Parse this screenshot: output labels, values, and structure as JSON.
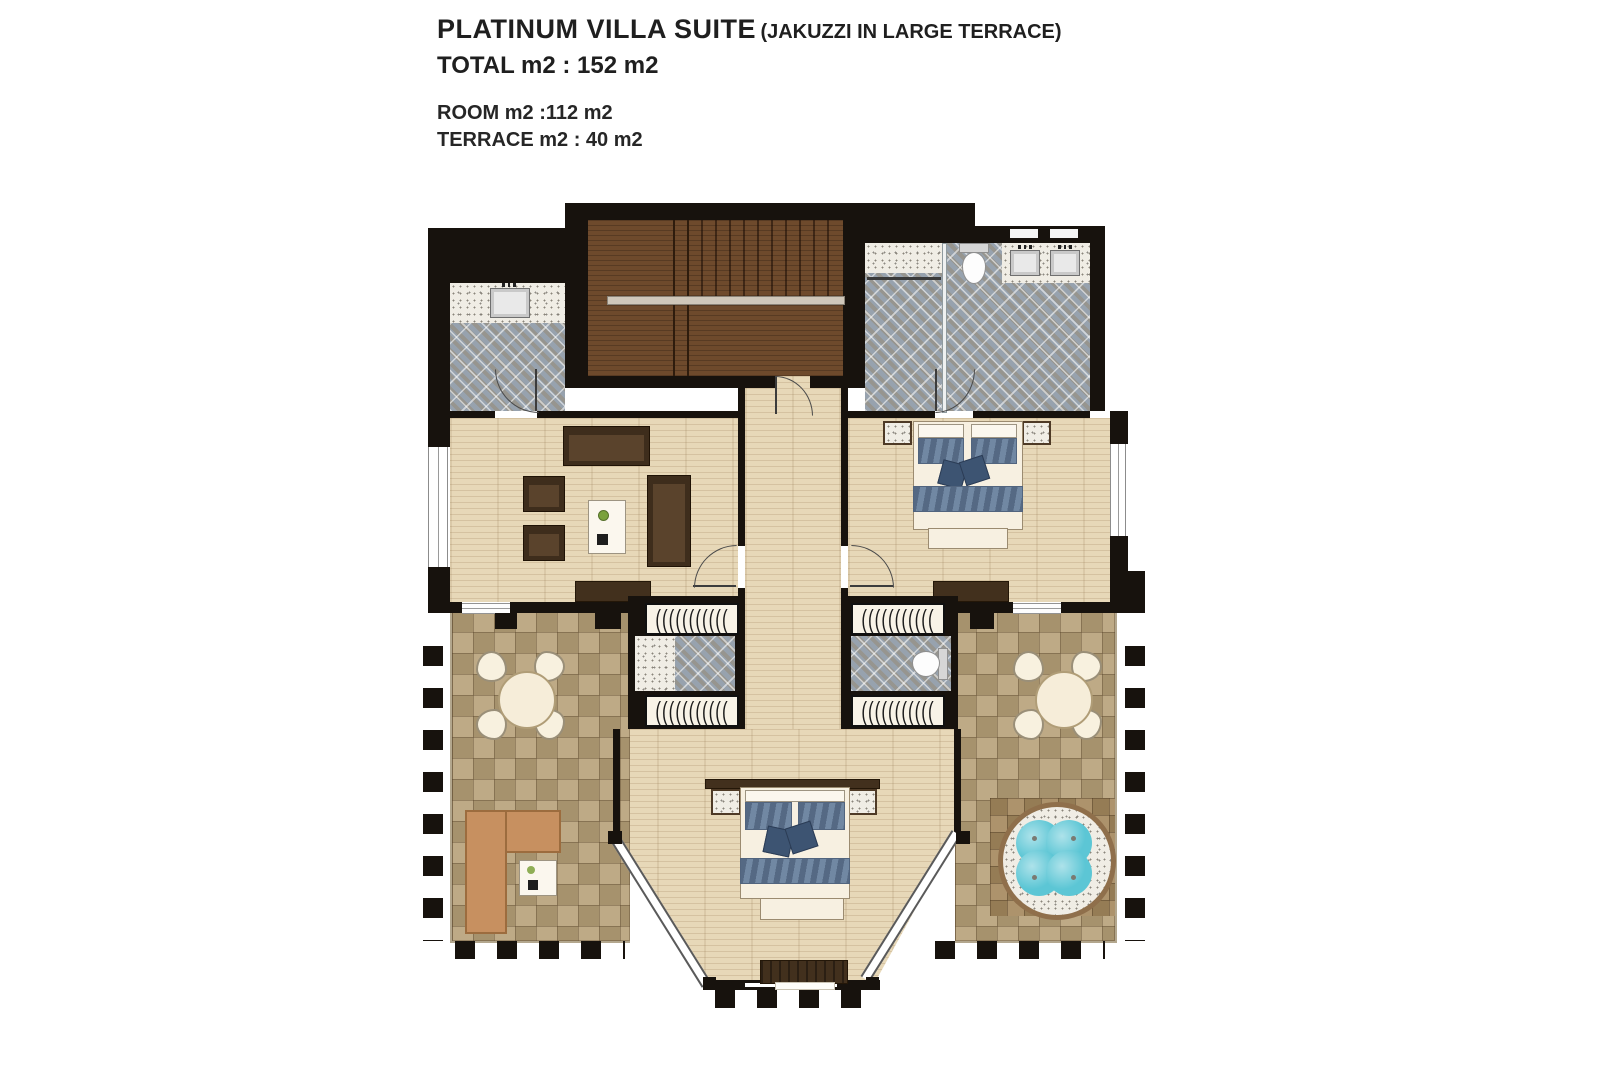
{
  "header": {
    "title": "PLATINUM VILLA SUITE",
    "subtitle": "(JAKUZZI IN LARGE TERRACE)",
    "total_line": "TOTAL m2 : 152 m2",
    "room_line": "ROOM m2 :112 m2",
    "terrace_line": "TERRACE m2 : 40 m2"
  },
  "glyphs": {
    "hanger_row": "((((((((((("
  },
  "colors": {
    "wall": "#17120d",
    "wood_floor": "#e7d8b8",
    "stair_wood": "#6e4a2c",
    "terrace_tile": "#b7a078",
    "mosaic_tile": "#97a2ae",
    "granite": "#f0ede5",
    "dark_furniture": "#42301d",
    "textile_blue": "#7188a3",
    "sofa_tan": "#c79060",
    "jacuzzi_water": "#5cc6d5"
  }
}
